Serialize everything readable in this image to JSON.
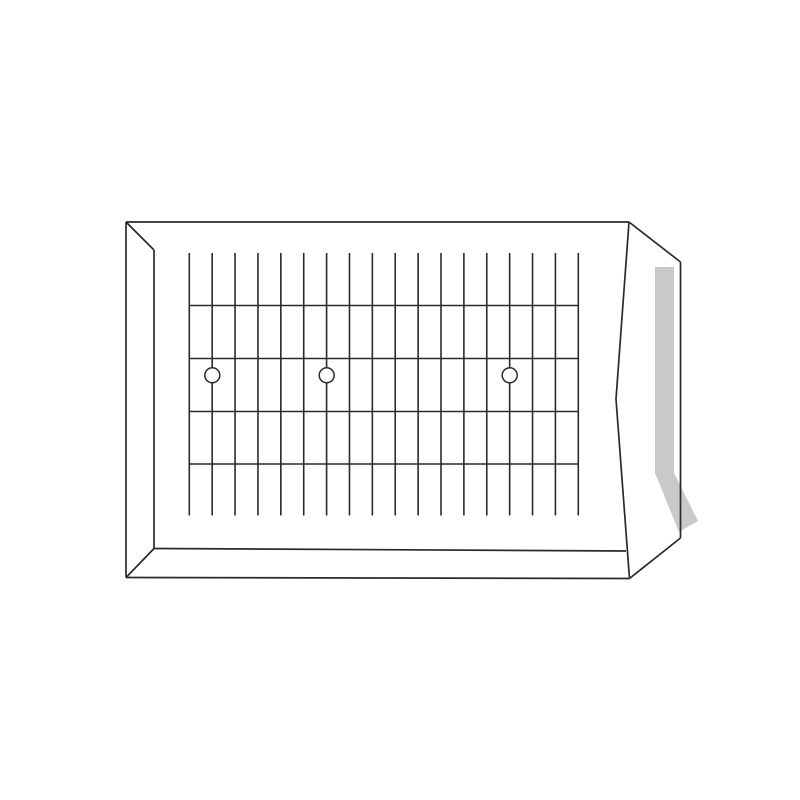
{
  "canvas": {
    "width": 800,
    "height": 800,
    "background": "#ffffff"
  },
  "colors": {
    "line": "#2a2a2d",
    "seal_strip": "#c9c9c9",
    "eyelet_fill": "#ffffff"
  },
  "strokes": {
    "frame_width": 1.7,
    "mesh_width": 1.6,
    "eyelet_width": 1.5
  },
  "drawing": {
    "subject": "gridded-panel-envelope-line-drawing",
    "seal_strip": {
      "vertical": {
        "x": 655,
        "y": 267,
        "width": 19,
        "height": 206
      },
      "angled_polygon": [
        [
          655,
          473
        ],
        [
          674,
          473
        ],
        [
          698,
          521
        ],
        [
          679,
          532
        ]
      ]
    },
    "mesh": {
      "vertical_wires": {
        "count": 18,
        "x_start": 189.3,
        "x_end": 578.3,
        "y_top": 253,
        "y_bottom": 515.5
      },
      "horizontal_wires": {
        "y_values": [
          305.5,
          358.5,
          411.5,
          464
        ],
        "x_start": 189.3,
        "x_end": 578.3
      },
      "eyelets": {
        "radius": 7.5,
        "centers": [
          [
            212.3,
            375.3
          ],
          [
            326.7,
            375.3
          ],
          [
            509.7,
            375.3
          ]
        ]
      }
    },
    "outline_paths": [
      {
        "name": "front-top-edge",
        "points": [
          [
            126,
            222
          ],
          [
            629,
            222
          ]
        ]
      },
      {
        "name": "front-left-outer-edge",
        "points": [
          [
            126,
            222
          ],
          [
            126,
            577.5
          ]
        ]
      },
      {
        "name": "front-bottom-outer-edge",
        "points": [
          [
            126,
            577.5
          ],
          [
            629.5,
            578.5
          ]
        ]
      },
      {
        "name": "front-right-edge",
        "points": [
          [
            629,
            222
          ],
          [
            616,
            399
          ],
          [
            629.5,
            578.5
          ]
        ]
      },
      {
        "name": "front-top-left-bevel",
        "points": [
          [
            126,
            222
          ],
          [
            154,
            250
          ]
        ]
      },
      {
        "name": "front-left-inner-edge",
        "points": [
          [
            154,
            250
          ],
          [
            154,
            548.5
          ]
        ]
      },
      {
        "name": "front-bottom-left-bevel",
        "points": [
          [
            154,
            548.5
          ],
          [
            126,
            577.5
          ]
        ]
      },
      {
        "name": "front-bottom-inner-edge",
        "points": [
          [
            154,
            548.5
          ],
          [
            626,
            551
          ]
        ]
      },
      {
        "name": "back-top-bevel",
        "points": [
          [
            629,
            222
          ],
          [
            680.5,
            262
          ]
        ]
      },
      {
        "name": "back-right-edge",
        "points": [
          [
            680.5,
            262
          ],
          [
            680.5,
            538
          ]
        ]
      },
      {
        "name": "back-bottom-bevel",
        "points": [
          [
            680.5,
            538
          ],
          [
            629.5,
            578.5
          ]
        ]
      }
    ]
  }
}
